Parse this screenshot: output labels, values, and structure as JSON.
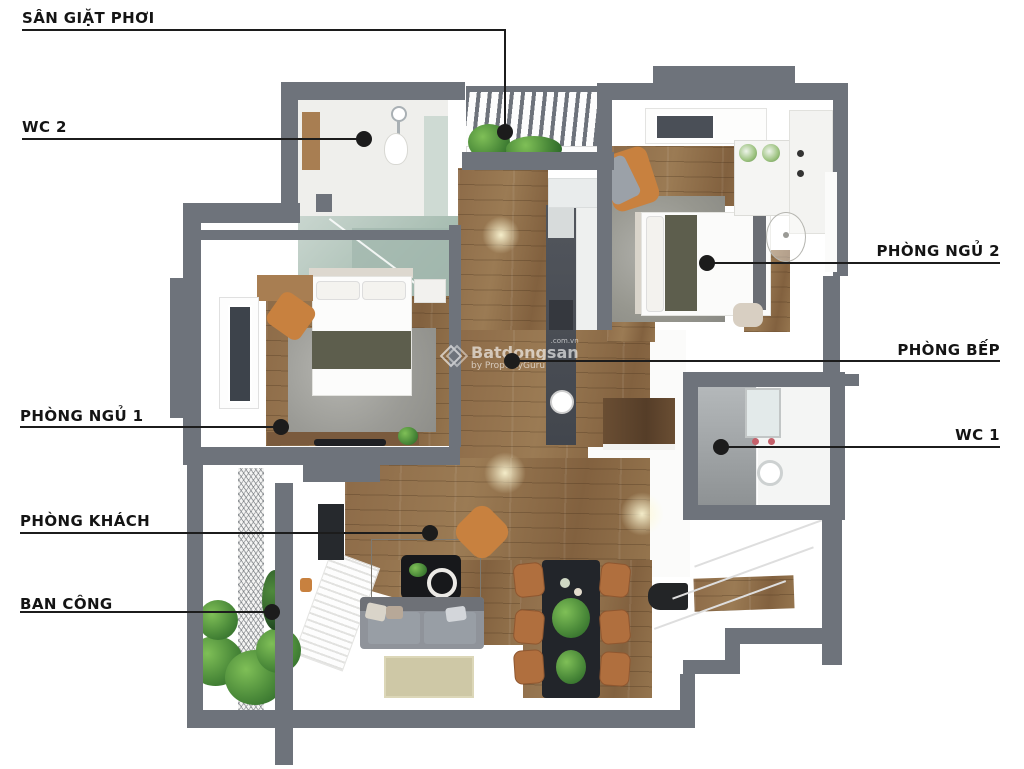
{
  "title": "Apartment floor plan (3D top view)",
  "labels": {
    "san_giat_phoi": "SÂN GIẶT PHƠI",
    "wc_2": "WC 2",
    "phong_ngu_2": "PHÒNG NGỦ 2",
    "phong_bep": "PHÒNG BẾP",
    "wc_1": "WC 1",
    "phong_ngu_1": "PHÒNG NGỦ 1",
    "phong_khach": "PHÒNG KHÁCH",
    "ban_cong": "BAN CÔNG"
  },
  "watermark": {
    "suffix": ".com.vn",
    "brand": "Batdongsan",
    "byline": "by PropertyGuru"
  },
  "colors": {
    "wall": "#6e737b",
    "line": "#1c1c1c",
    "label": "#141414",
    "wood": "#92714e",
    "orange": "#c8813f",
    "olive": "#5d5e4d",
    "rug": "#a2a29d",
    "counter": "#494d54",
    "cabinet": "#5f4630",
    "tile": "#a9adb0",
    "glass": "#b7c7bd",
    "sofa": "#8f939a",
    "chair_tan": "#b06f3e",
    "mat": "#232527",
    "plant": "#4c8b3a"
  }
}
